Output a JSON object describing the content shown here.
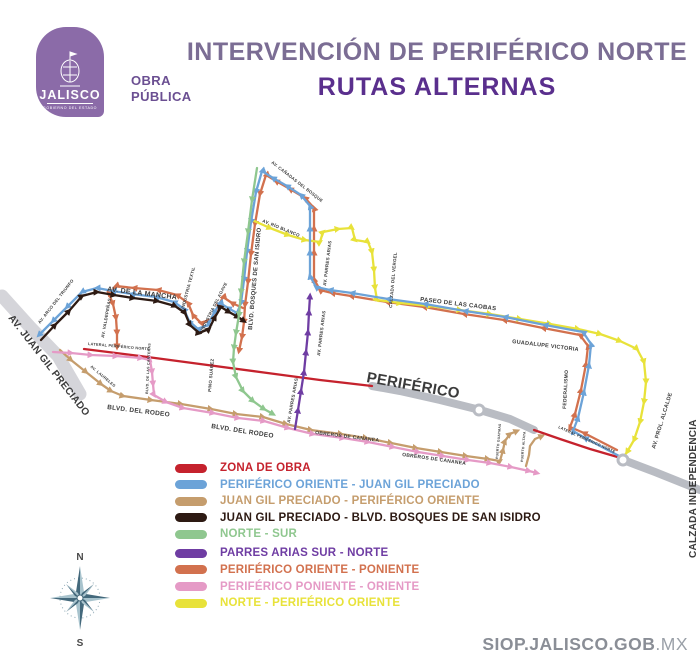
{
  "header": {
    "logo": {
      "state": "JALISCO",
      "substate": "GOBIERNO DEL ESTADO"
    },
    "dept_line1": "OBRA",
    "dept_line2": "PÚBLICA",
    "title_line1": "INTERVENCIÓN DE PERIFÉRICO NORTE",
    "title_line2": "RUTAS ALTERNAS"
  },
  "colors": {
    "red": "#c5222d",
    "blue": "#6ca3d8",
    "tan": "#c59d6d",
    "black": "#2d1a13",
    "green": "#8fc78f",
    "purple": "#6f3da3",
    "orange": "#d2714e",
    "pink": "#e59ac6",
    "yellow": "#e8e23a",
    "gray_road": "#b9bcc3",
    "light_road": "#d5d5da"
  },
  "map": {
    "periferico_label": "PERIFÉRICO",
    "labels": [
      "AV. JUAN GIL PRECIADO",
      "AV. ARCO DEL TRIUNFO",
      "AV. DE LA MANCHA",
      "AV. VALDEPEÑAS",
      "INDUSTRIA TEXTIL",
      "INDUSTRIA DEL AGAVE",
      "BLVD. BOSQUES DE SAN ISIDRO",
      "AV. CAÑADAS DEL BOSQUE",
      "AV. RÍO BLANCO",
      "AV. PARRES ARIAS",
      "CALZADA DEL VERGEL",
      "PASEO DE LAS CAOBAS",
      "GUADALUPE VICTORIA",
      "FEDERALISMO",
      "AV. PROL. ALCALDE",
      "CALZADA INDEPENDENCIA",
      "LATERAL PERIFÉRICO NORTE",
      "LATERAL PERIFÉRICO NORTE",
      "PINO SUÁREZ",
      "AV. LAURELES",
      "BLVD. DE LAS CANTERAS",
      "BLVD. DEL RODEO",
      "BLVD. DEL RODEO",
      "OBREROS DE CANANEA",
      "OBREROS DE CANANEA",
      "AV. PARRES ARIAS",
      "AV. PARRES ARIAS",
      "PUERTO GUAYMAS",
      "PUERTO ALTATA"
    ],
    "compass": {
      "north": "N",
      "south": "S"
    }
  },
  "legend": {
    "items": [
      {
        "label": "ZONA DE OBRA",
        "color": "#c5222d"
      },
      {
        "label": "PERIFÉRICO ORIENTE - JUAN GIL PRECIADO",
        "color": "#6ca3d8"
      },
      {
        "label": "JUAN GIL PRECIADO - PERIFÉRICO ORIENTE",
        "color": "#c59d6d"
      },
      {
        "label": "JUAN GIL PRECIADO - BLVD. BOSQUES DE SAN ISIDRO",
        "color": "#2d1a13"
      },
      {
        "label": "NORTE - SUR",
        "color": "#8fc78f"
      },
      {
        "label": "PARRES ARIAS SUR - NORTE",
        "color": "#6f3da3"
      },
      {
        "label": "PERIFÉRICO ORIENTE - PONIENTE",
        "color": "#d2714e"
      },
      {
        "label": "PERIFÉRICO PONIENTE - ORIENTE",
        "color": "#e59ac6"
      },
      {
        "label": "NORTE - PERIFÉRICO ORIENTE",
        "color": "#e8e23a"
      }
    ]
  },
  "footer": {
    "site_bold": "SIOP.JALISCO.GOB",
    "site_light": ".MX"
  }
}
